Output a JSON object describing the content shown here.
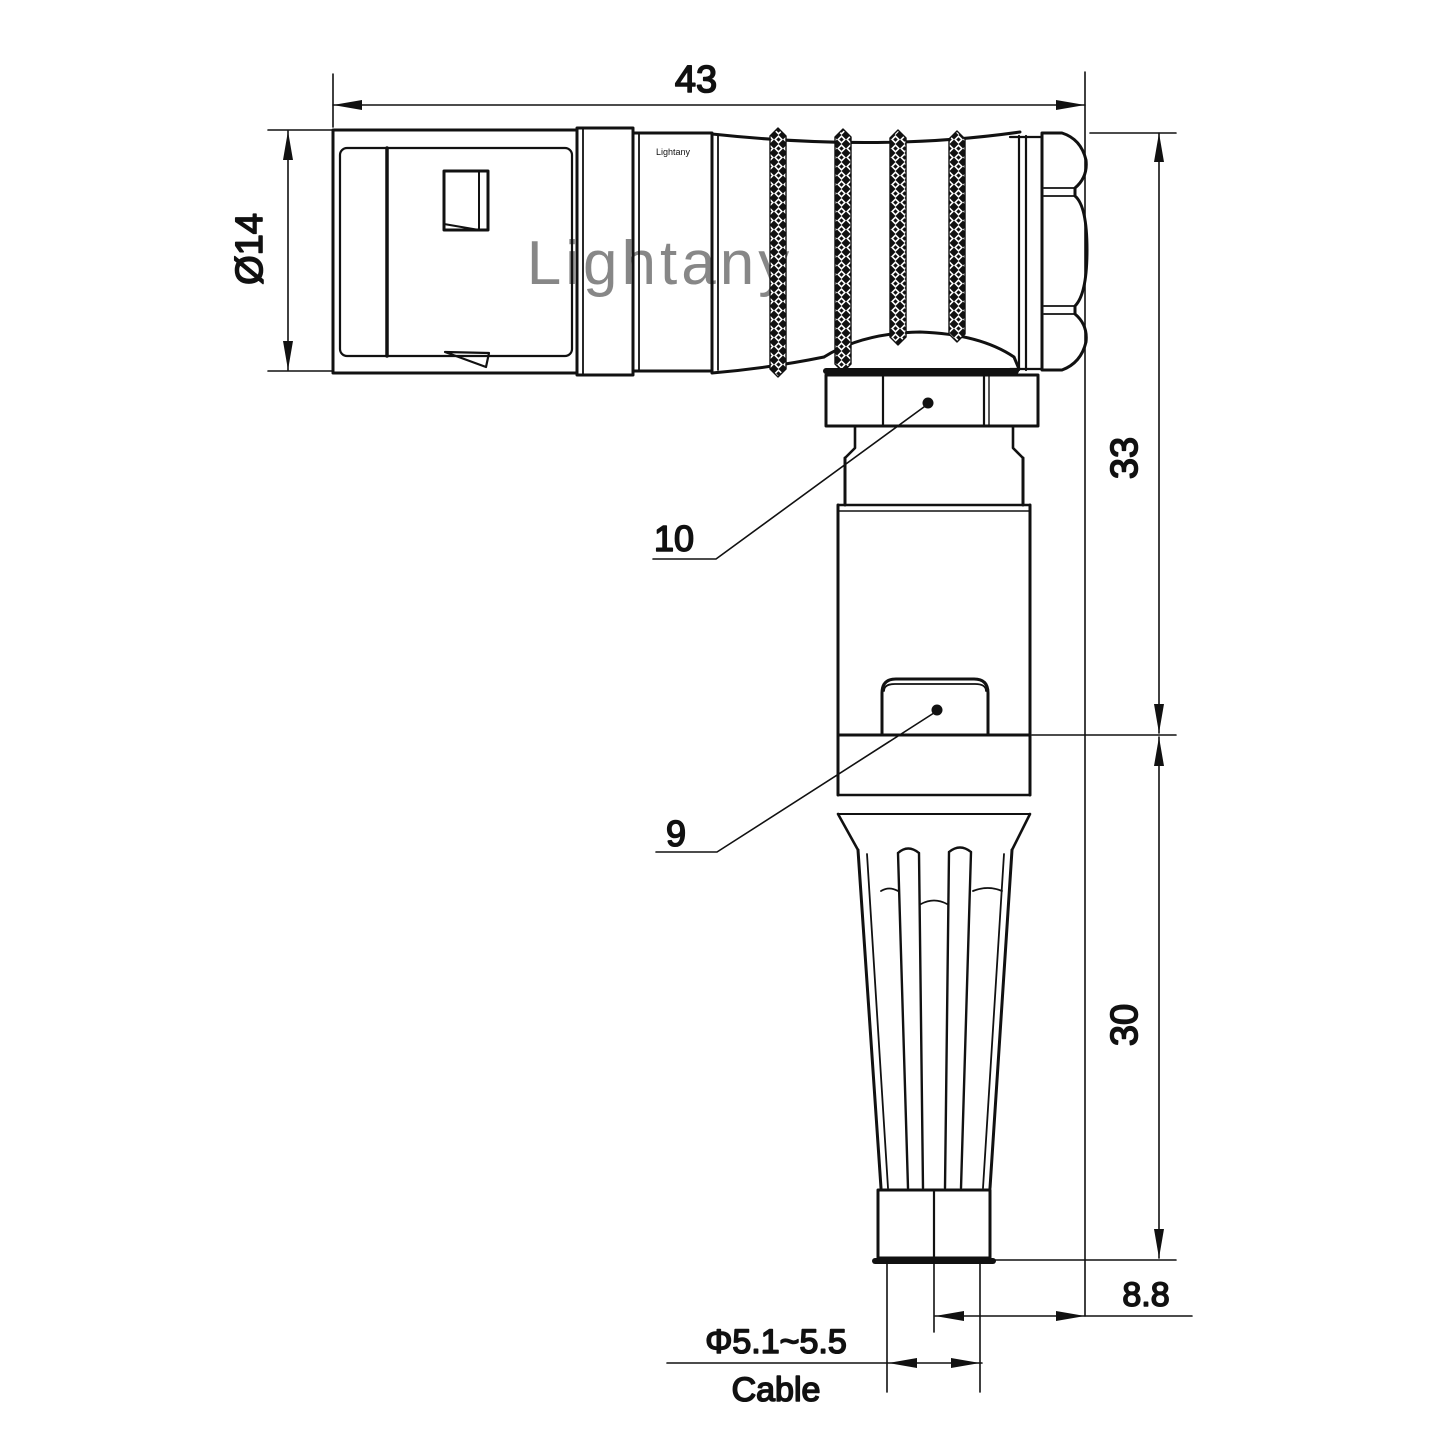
{
  "page": {
    "background": "#ffffff",
    "line_color": "#111111",
    "watermark_color": "#efb0b0"
  },
  "watermark": {
    "text": "Lightany"
  },
  "brand_mark": {
    "text": "Lightany"
  },
  "dimensions": {
    "overall_length": {
      "value": "43"
    },
    "front_diameter": {
      "value": "Ø14"
    },
    "upper_height": {
      "value": "33"
    },
    "lower_height": {
      "value": "30"
    },
    "cable_offset": {
      "value": "8.8"
    },
    "cable_diameter": {
      "value": "Φ5.1~5.5"
    },
    "cable_label": "Cable"
  },
  "part_labels": {
    "coupling_nut": "10",
    "strain_relief_body": "9"
  }
}
